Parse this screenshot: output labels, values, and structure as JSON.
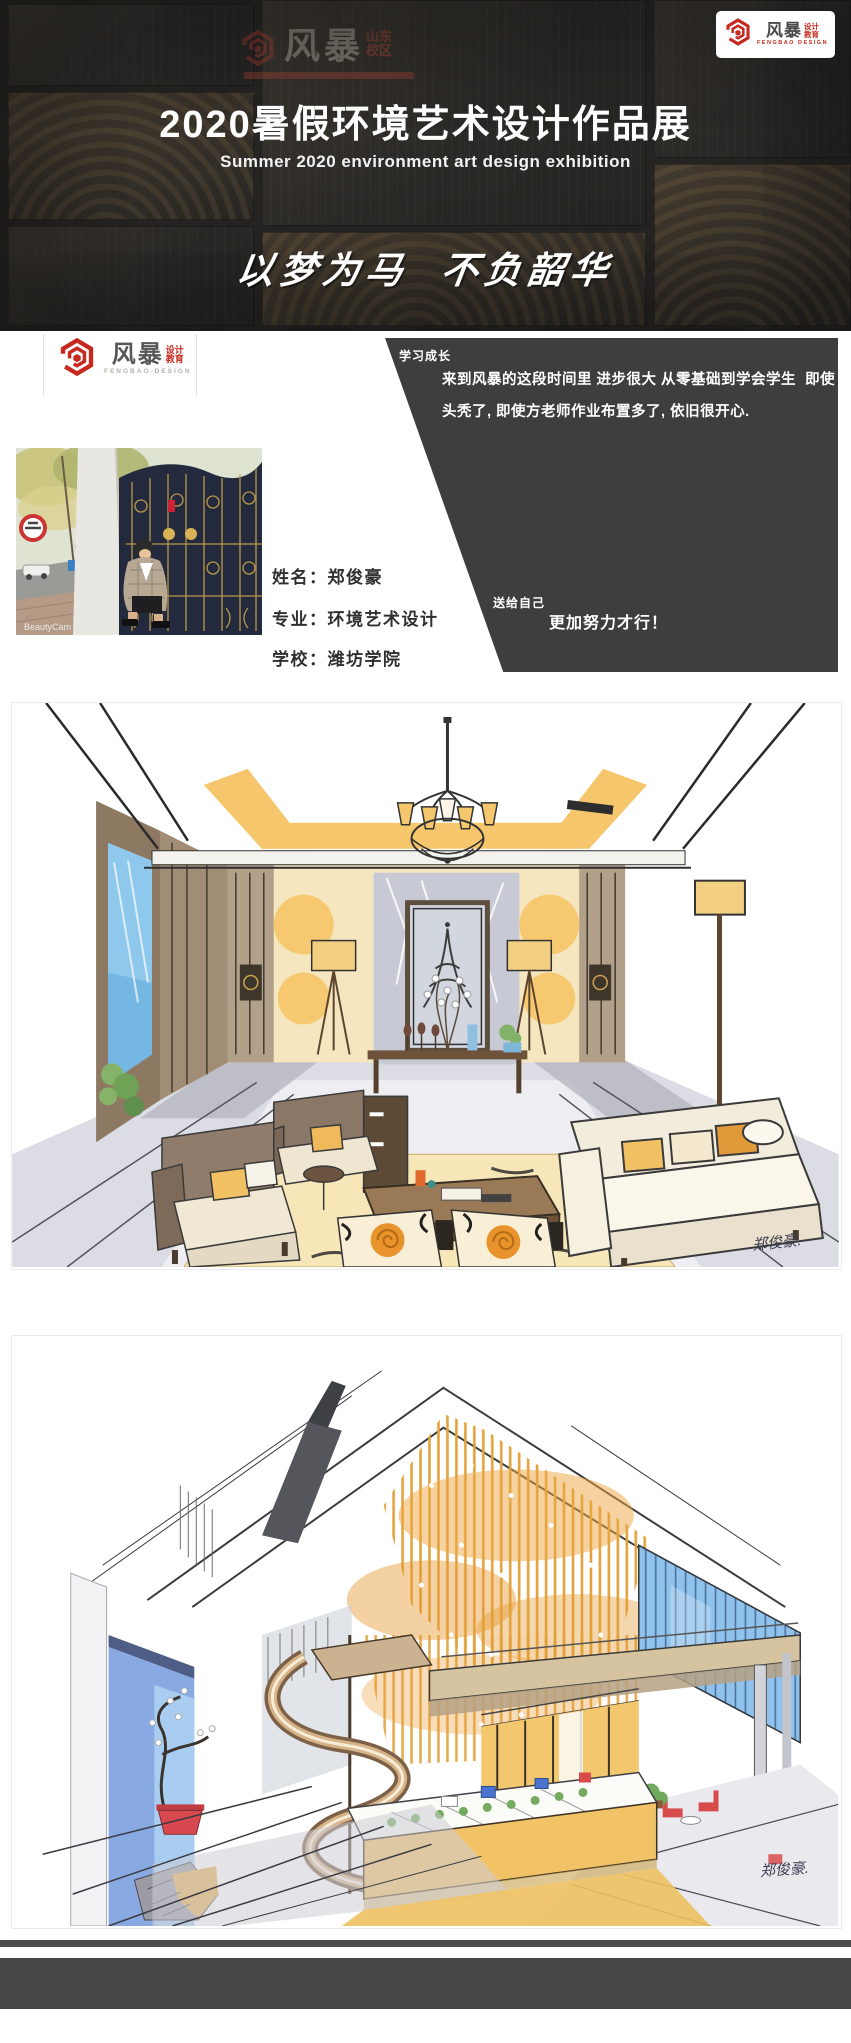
{
  "header": {
    "title": "2020暑假环境艺术设计作品展",
    "subtitle": "Summer 2020  environment art design exhibition",
    "slogan": "以梦为马  不负韶华",
    "logo_box": {
      "cn": "风暴",
      "suffix1": "设计",
      "suffix2": "教育",
      "en": "FENGBAO DESIGN"
    },
    "watermark": {
      "cn": "风暴",
      "region1": "山东",
      "region2": "校区"
    }
  },
  "profile": {
    "logo": {
      "cn": "风暴",
      "suffix1": "设计",
      "suffix2": "教育",
      "en": "FENGBAO-DESIGN"
    },
    "growth": {
      "label": "学习成长",
      "line1": "来到风暴的这段时间里 进步很大 从零基础到学会学生  即使",
      "line2": "头秃了, 即使方老师作业布置多了, 依旧很开心."
    },
    "gift": {
      "label": "送给自己",
      "text": "更加努力才行！"
    },
    "info": [
      {
        "label": "姓名：",
        "value": "郑俊豪"
      },
      {
        "label": "专业：",
        "value": "环境艺术设计"
      },
      {
        "label": "学校：",
        "value": "潍坊学院"
      }
    ],
    "photo_watermark": "BeautyCam"
  },
  "artworks": [
    {
      "signature": "郑俊豪."
    },
    {
      "signature": "郑俊豪."
    }
  ],
  "colors": {
    "accent_red": "#c5291f",
    "header_dark": "#262523",
    "panel_dark": "#3e3e3e",
    "footer_gray": "#464646",
    "artwork_yellow": "#f2c164",
    "artwork_blue": "#8fc2ec"
  }
}
